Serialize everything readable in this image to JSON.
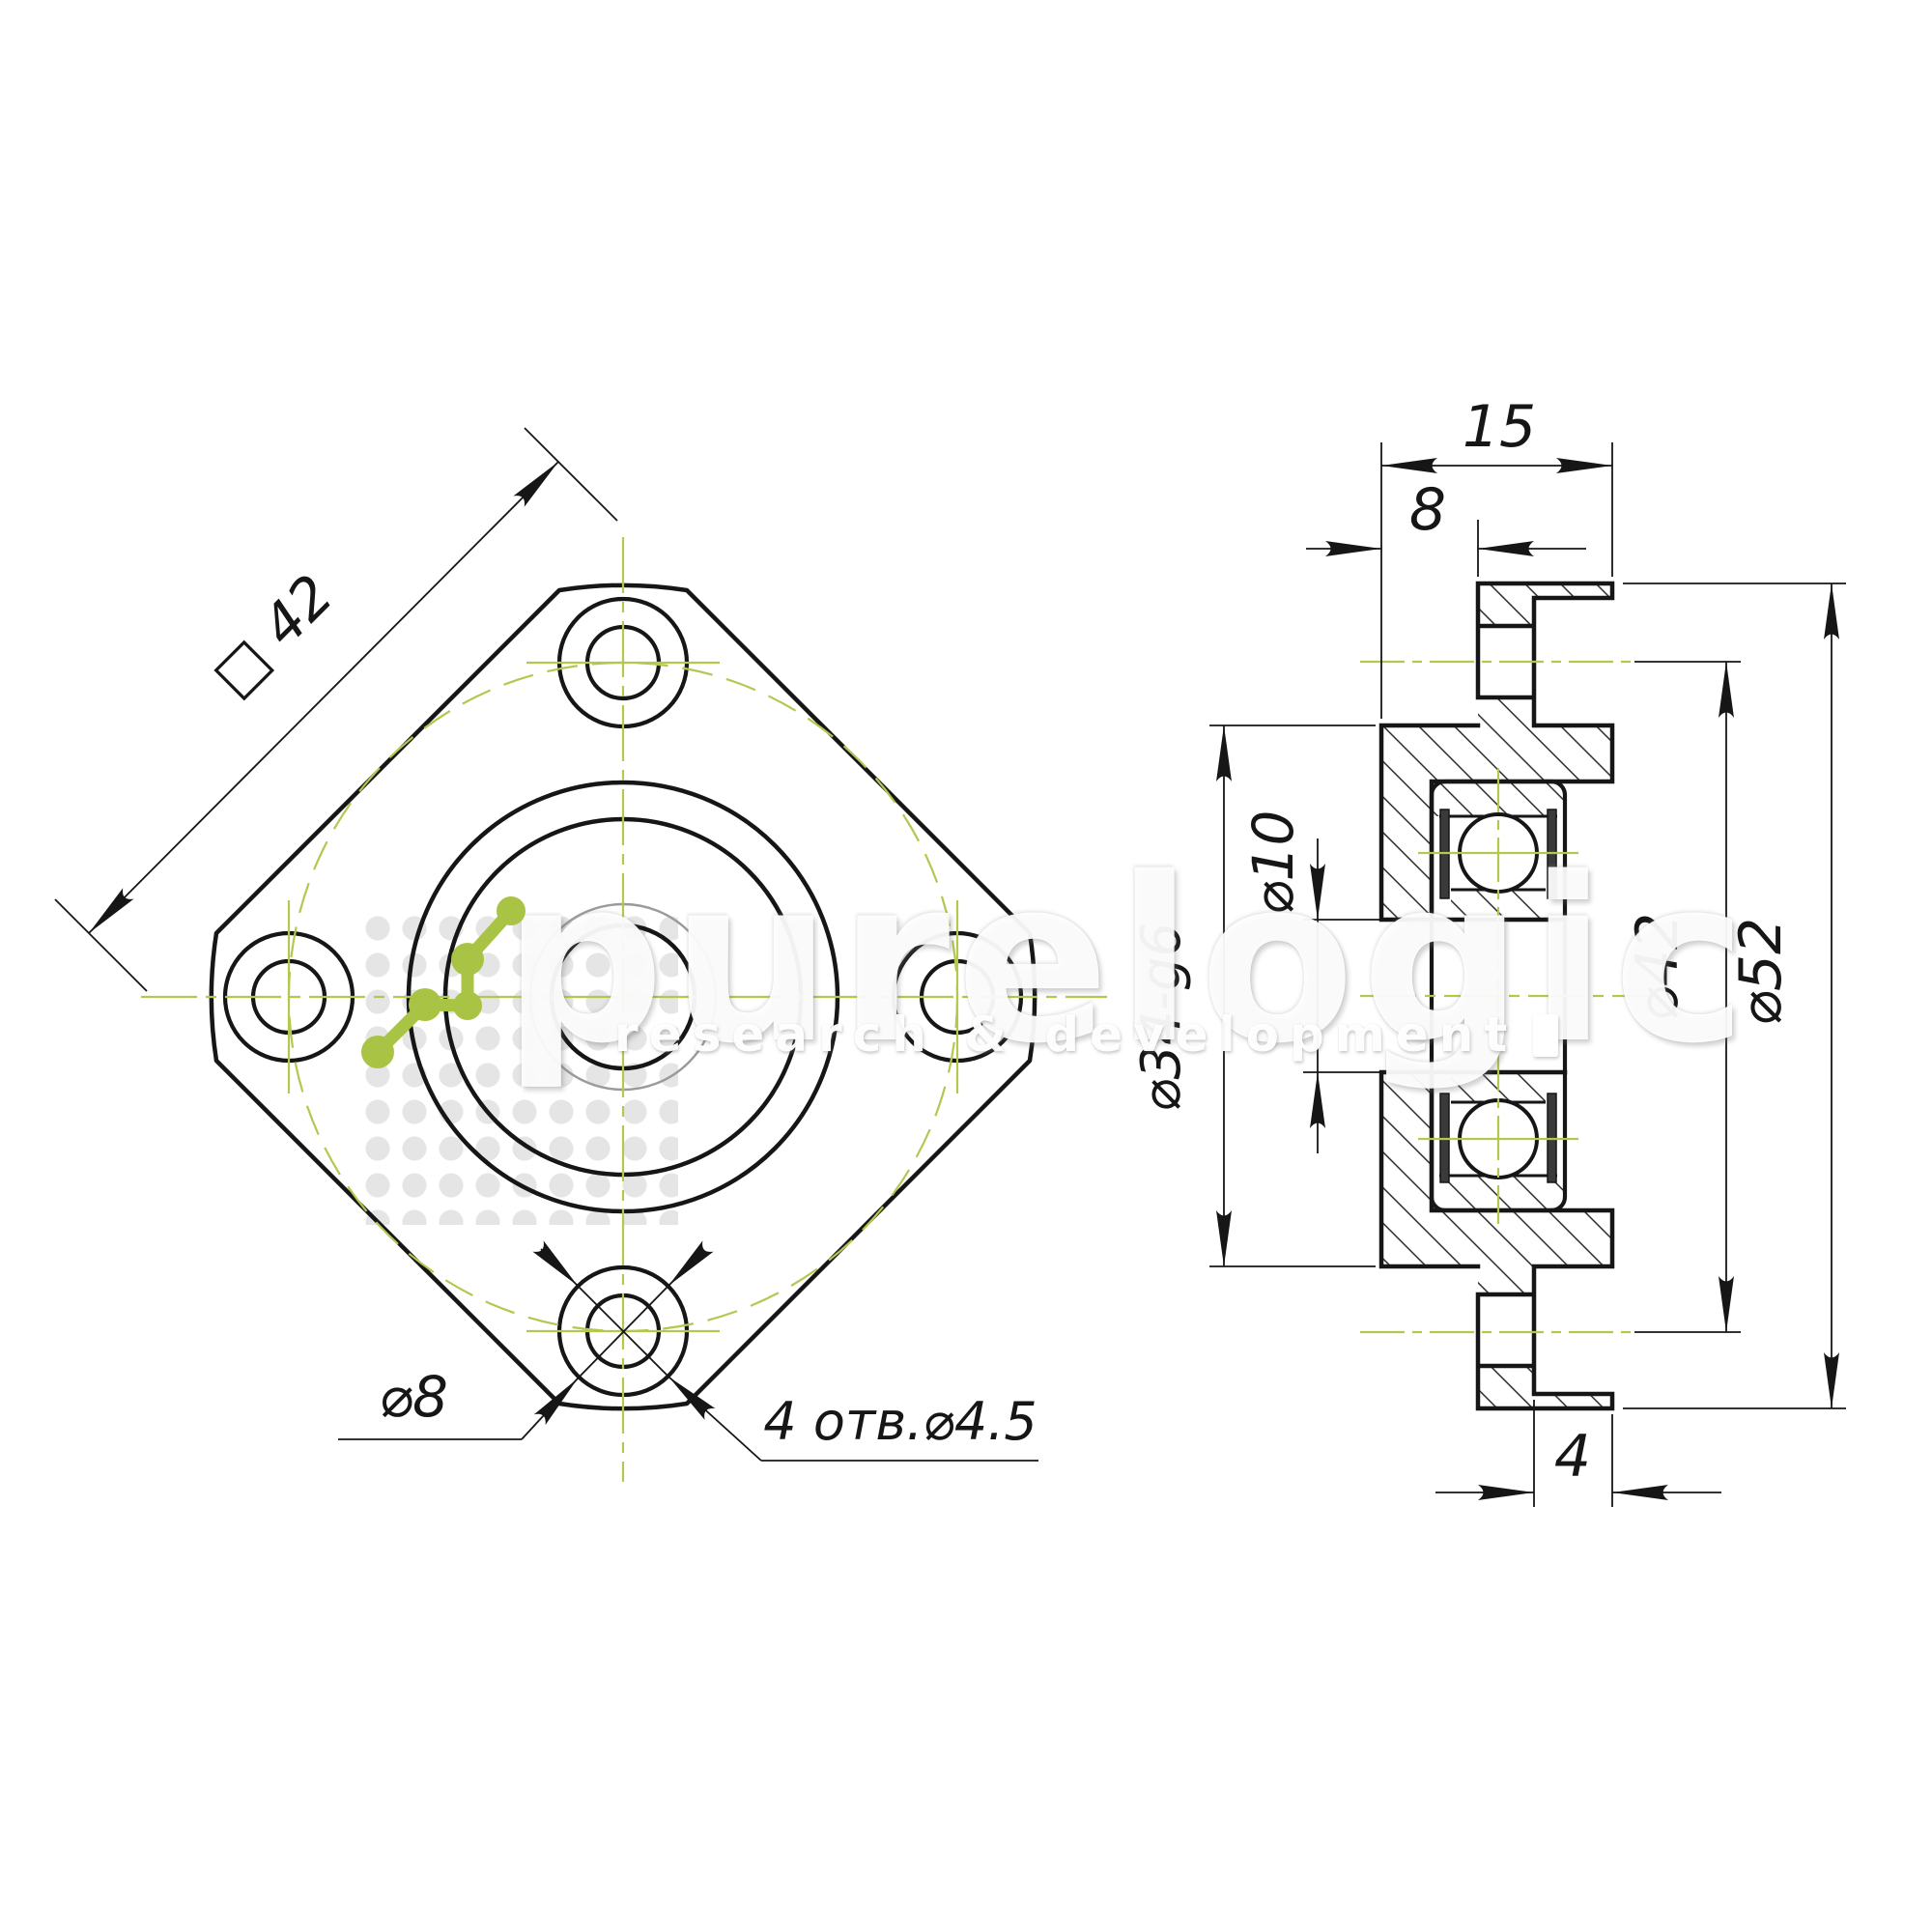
{
  "canvas": {
    "background": "#ffffff",
    "ink_color": "#161616",
    "centerline_green": "#b4c74f",
    "thin_gray": "#9a9a9a"
  },
  "watermark": {
    "brand": "purelogic",
    "tagline": "research & development"
  },
  "front_view": {
    "labels": {
      "square_flange": "□ 42",
      "counterbore_dia": "⌀8",
      "holes_note": "4 отв.⌀4.5"
    }
  },
  "side_view": {
    "labels": {
      "overall_width": "15",
      "hub_offset": "8",
      "counterbore_depth": "4",
      "bore_dia": "⌀10",
      "pilot_dia": "⌀34-g6",
      "bolt_circle_dia": "⌀42",
      "flange_dia": "⌀52"
    }
  }
}
